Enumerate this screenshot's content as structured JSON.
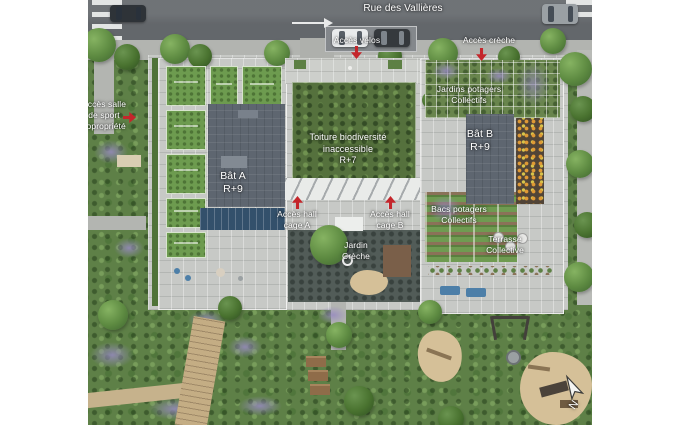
{
  "scene": {
    "type": "residential site plan (top view render)",
    "street": {
      "name": "Rue des Vallières",
      "direction_arrow": "right"
    },
    "access_points": {
      "velos": {
        "label": "Accès vélos",
        "marker": "red-arrow-down"
      },
      "creche": {
        "label": "Accès crèche",
        "marker": "red-arrow-down"
      },
      "salle_sport": {
        "label": "Accès salle\nde sport\ncopropriété",
        "marker": "red-arrow-right"
      },
      "hall_a": {
        "label": "Accès hall\ncage A",
        "marker": "red-arrow-up"
      },
      "hall_b": {
        "label": "Accès hall\ncage B",
        "marker": "red-arrow-up"
      }
    },
    "buildings": {
      "bat_a": {
        "label": "Bât A\nR+9"
      },
      "bat_b": {
        "label": "Bât B\nR+9"
      },
      "toiture": {
        "label": "Toiture biodiversité\ninaccessible\nR+7"
      }
    },
    "gardens": {
      "jardin_creche": {
        "label": "Jardin\nCrèche"
      },
      "jardins_potagers": {
        "label": "Jardins potagers\nCollectifs"
      },
      "bacs_potagers": {
        "label": "Bacs potagers\nCollectifs"
      },
      "terrasse": {
        "label": "Terrasse\nCollective"
      }
    },
    "compass": {
      "north": "N"
    },
    "icons": {
      "access_marker": "red-arrow",
      "street_arrow": "white-arrow-right",
      "compass": "north-arrow"
    },
    "colors": {
      "marker_red": "#c4262b",
      "road_asphalt": "#63676b",
      "paving": "#c7c9c6",
      "roof_slate": "#5e6670",
      "biodiversity_roof_green": "#55713d",
      "solar_panel_blue": "#33506b",
      "sand": "#d5c098",
      "label_text": "#ffffff"
    }
  }
}
